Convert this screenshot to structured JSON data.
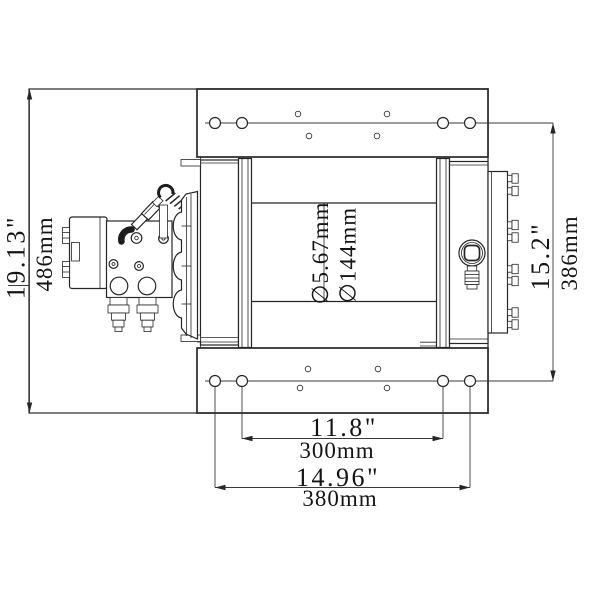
{
  "title": "Hydraulic winch dimensional drawing",
  "colors": {
    "line": "#262626",
    "background": "#ffffff"
  },
  "dimensions": {
    "overall_length": {
      "inches": "19.13\"",
      "metric": "486mm"
    },
    "drum_diameter": {
      "label_a": "∅5.67mm",
      "label_b": "∅144mm"
    },
    "mount_vertical": {
      "inches": "15.2\"",
      "metric": "386mm"
    },
    "bolt_span_inner": {
      "inches": "11.8\"",
      "metric": "300mm"
    },
    "bolt_span_outer": {
      "inches": "14.96\"",
      "metric": "380mm"
    }
  }
}
